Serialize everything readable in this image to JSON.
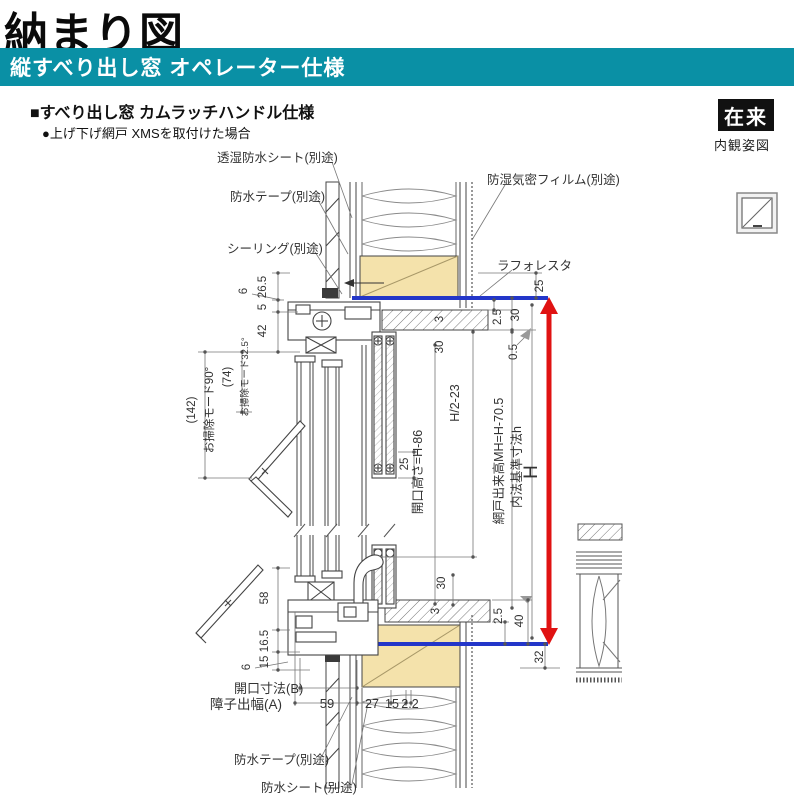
{
  "header": {
    "title": "納まり図",
    "banner": "縦すべり出し窓 オペレーター仕様",
    "spec1": "■すべり出し窓 カムラッチハンドル仕様",
    "spec2": "●上げ下げ網戸 XMSを取付けた場合"
  },
  "badge": {
    "label": "在来",
    "caption": "内観姿図"
  },
  "annotations": {
    "sheet_top": "透湿防水シート(別途)",
    "tape_top": "防水テープ(別途)",
    "sealing": "シーリング(別途)",
    "film": "防湿気密フィルム(別途)",
    "laforesta": "ラフォレスタ",
    "tape_bottom": "防水テープ(別途)",
    "sheet_bottom": "防水シート(別途)"
  },
  "dims": {
    "d6_top": "6",
    "d26_5": "26.5",
    "d5": "5",
    "d42": "42",
    "mode90": "お掃除モード90°",
    "p142": "(142)",
    "mode32": "お掃除モード32.5°",
    "p74": "(74)",
    "d25_trim": "25",
    "d2_5_top": "2.5",
    "d30_right_top": "30",
    "d0_5": "0.5",
    "d3_top": "3",
    "d30_top": "30",
    "h2_23": "H/2-23",
    "d25_screen": "25",
    "opening_h": "開口高さ=H-86",
    "screen_h": "網戸出来高MH=H-70.5",
    "base_h": "内法基準寸法h",
    "H": "H",
    "d30_bottom": "30",
    "d3_bottom": "3",
    "d2_5_bottom": "2.5",
    "d40": "40",
    "d32": "32",
    "d58": "58",
    "d16_5": "16.5",
    "d15_left": "15",
    "d6_bottom": "6",
    "opening_b": "開口寸法(B)",
    "sash_a": "障子出幅(A)",
    "d59": "59",
    "d27": "27",
    "d15_bottom": "15",
    "d2_2": "2.2"
  },
  "colors": {
    "teal": "#0a90a5",
    "blue": "#2336c9",
    "red": "#e01212",
    "wood": "#f4e2ab"
  }
}
